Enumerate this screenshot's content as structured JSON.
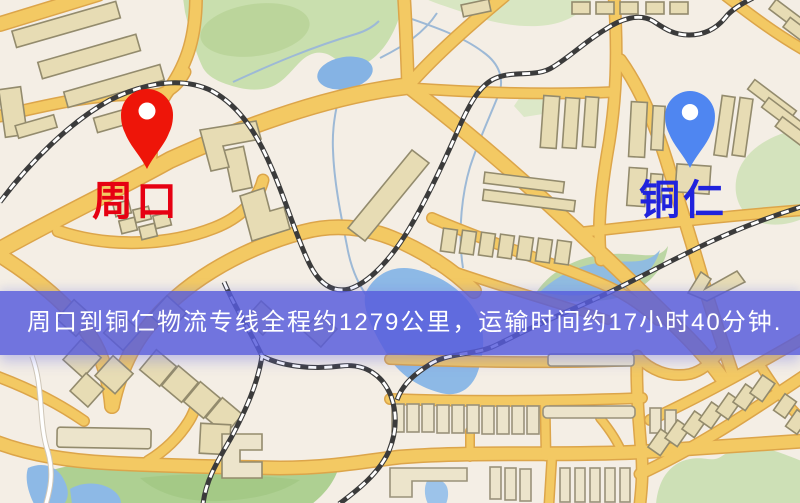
{
  "map": {
    "origin": {
      "label": "周口",
      "pin_color": "#ee1509",
      "label_color": "#e60012"
    },
    "destination": {
      "label": "铜仁",
      "pin_color": "#4f86f1",
      "label_color": "#2023dd"
    },
    "banner": {
      "text": "周口到铜仁物流专线全程约1279公里，运输时间约17小时40分钟.",
      "background_color": "#575bdc",
      "background_opacity": 0.83,
      "text_color": "#ffffff"
    },
    "route": {
      "distance_text": "约1279公里",
      "duration_text": "约17小时40分钟"
    },
    "palette": {
      "map_background": "#f4eee5",
      "road_fill": "#f3c963",
      "road_casing": "#dca54a",
      "building_fill": "#e7dcb4",
      "building_outline": "#938b6d",
      "park_green": "#c9dfae",
      "water_blue": "#8db9e6",
      "railway_dark": "#3b3b3b"
    }
  }
}
